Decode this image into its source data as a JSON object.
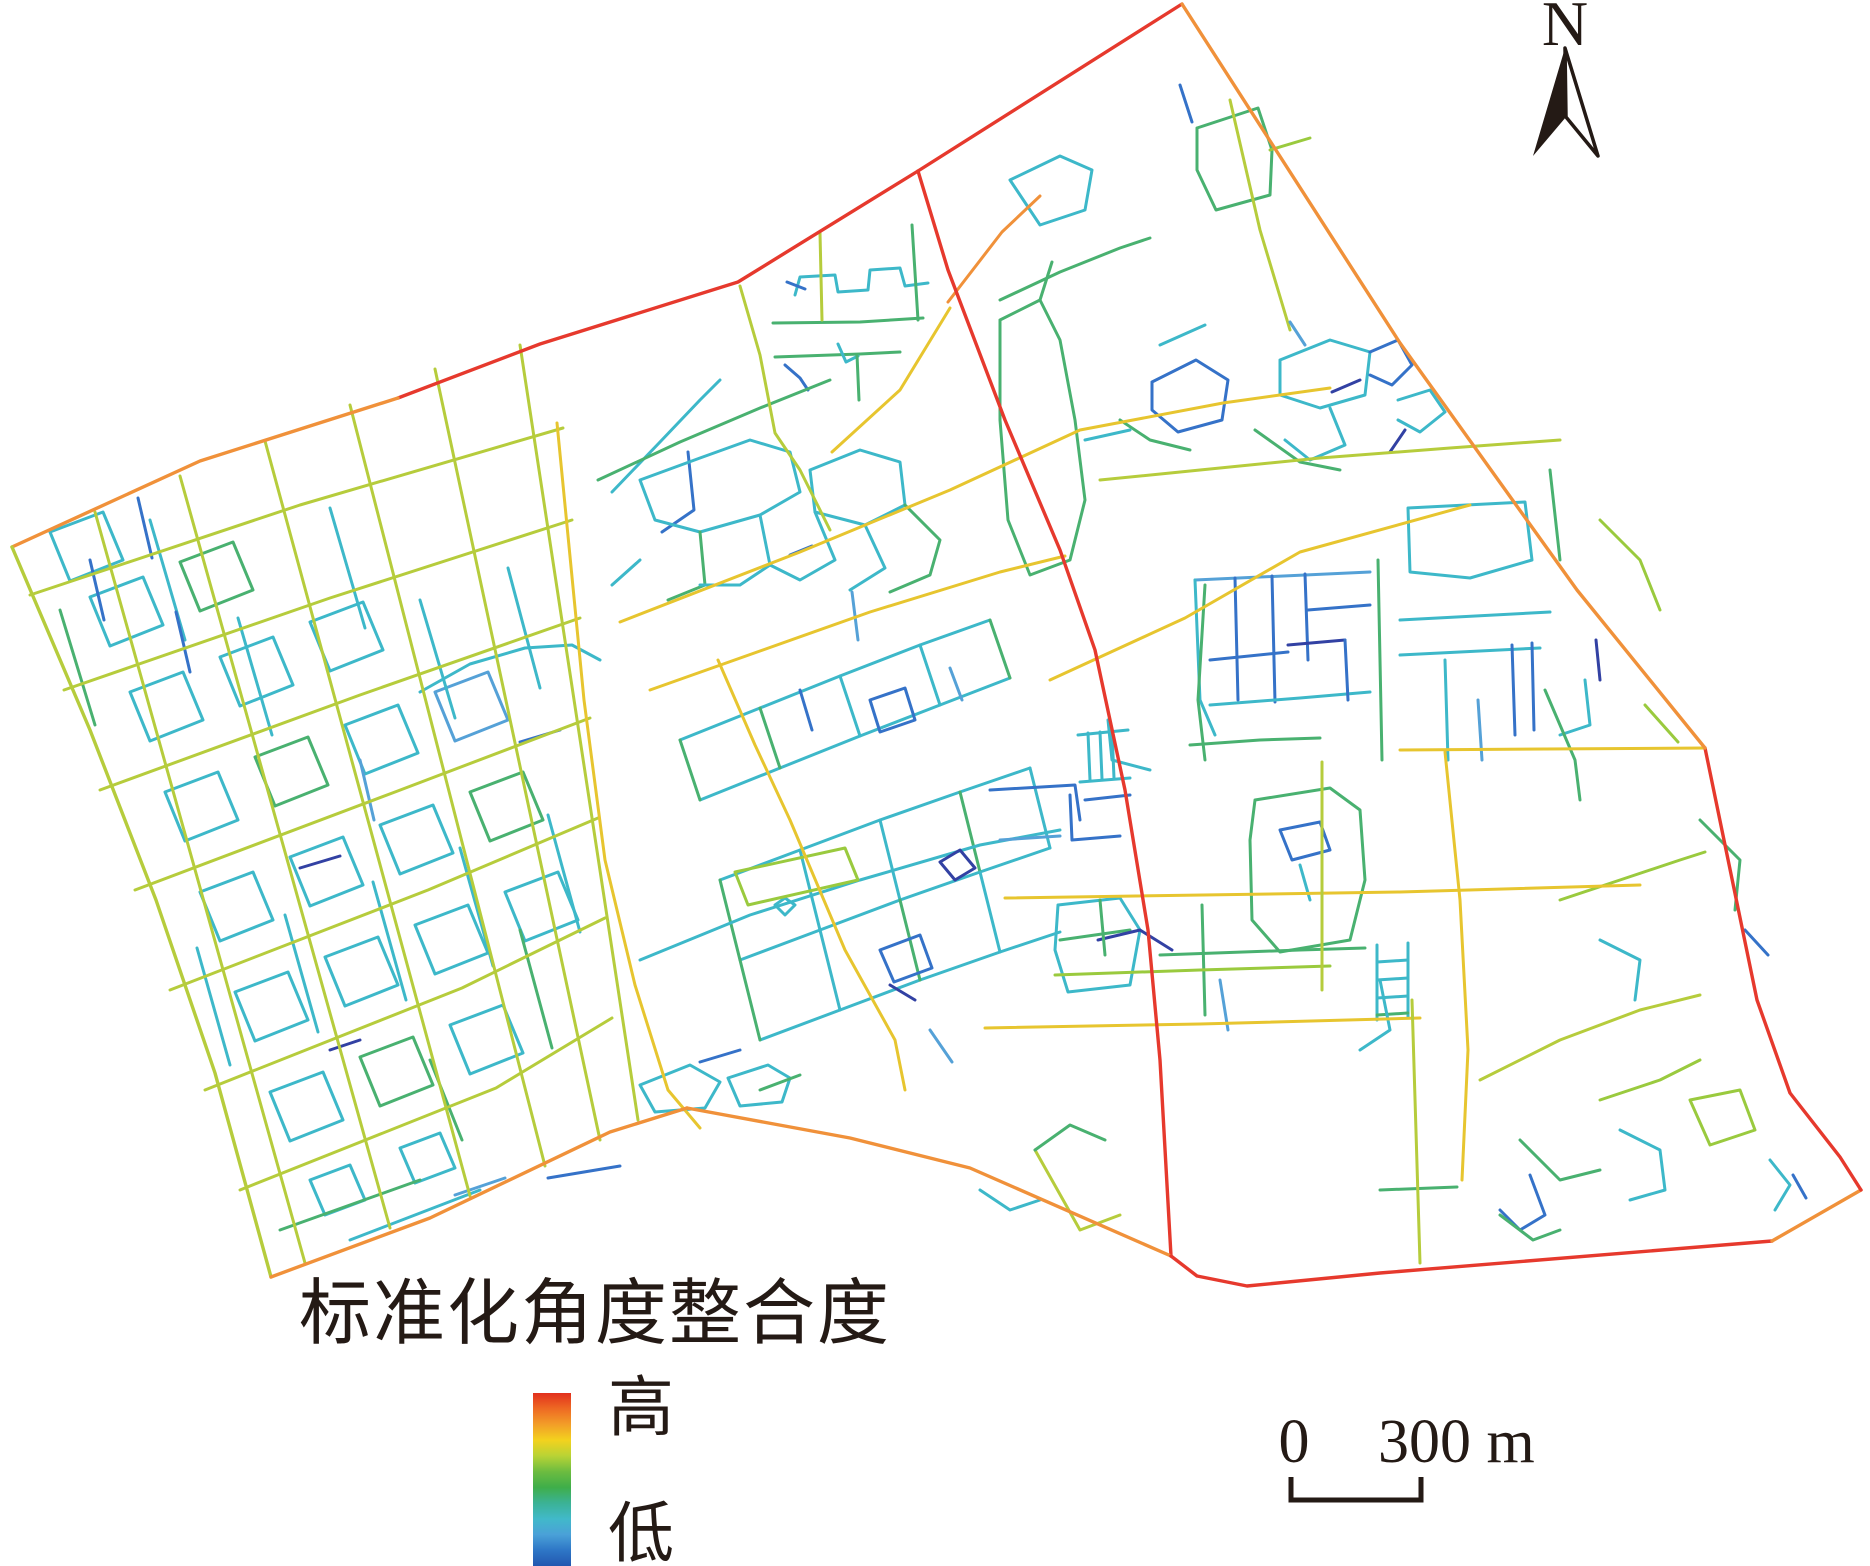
{
  "legend": {
    "title": "标准化角度整合度",
    "high_label": "高",
    "low_label": "低",
    "gradient": [
      "#e2301d",
      "#ee6a23",
      "#f29e28",
      "#f3d21e",
      "#b8d335",
      "#6cbc40",
      "#3fae49",
      "#3bb295",
      "#41b9c9",
      "#4aa1d8",
      "#2e76c6",
      "#2257b0"
    ]
  },
  "north_arrow": {
    "label": "N"
  },
  "scale_bar": {
    "zero_label": "0",
    "distance_label": "300 m"
  },
  "map": {
    "stroke_width": 3,
    "ink": "#241a15",
    "palette": {
      "r": "#e6392d",
      "o": "#f0913a",
      "g": "#e7c52f",
      "y": "#b6cc3c",
      "l": "#9aca3e",
      "e": "#49b170",
      "t": "#3db8c9",
      "lb": "#55a1d7",
      "b": "#3572c8",
      "d": "#3241a3"
    },
    "roads": [
      {
        "c": "t",
        "p": "50,532 103,512 123,560 70,581 50,532"
      },
      {
        "c": "t",
        "p": "90,597 143,577 163,625 110,646 90,597"
      },
      {
        "c": "e",
        "p": "180,562 233,542 253,590 200,611 180,562"
      },
      {
        "c": "t",
        "p": "130,692 183,672 203,720 150,741 130,692"
      },
      {
        "c": "t",
        "p": "220,657 273,637 293,685 240,706 220,657"
      },
      {
        "c": "t",
        "p": "310,622 363,602 383,650 330,671 310,622"
      },
      {
        "c": "t",
        "p": "165,792 218,772 238,820 185,841 165,792"
      },
      {
        "c": "e",
        "p": "255,757 308,737 328,785 275,806 255,757"
      },
      {
        "c": "t",
        "p": "345,725 398,705 418,753 365,774 345,725"
      },
      {
        "c": "lb",
        "p": "435,692 488,672 508,720 455,741 435,692"
      },
      {
        "c": "t",
        "p": "200,892 253,872 273,920 220,941 200,892"
      },
      {
        "c": "t",
        "p": "290,857 343,837 363,885 310,906 290,857"
      },
      {
        "c": "t",
        "p": "380,825 433,805 453,853 400,874 380,825"
      },
      {
        "c": "e",
        "p": "470,792 523,772 543,820 490,841 470,792"
      },
      {
        "c": "t",
        "p": "235,992 288,972 308,1020 255,1041 235,992"
      },
      {
        "c": "t",
        "p": "325,957 378,937 398,985 345,1006 325,957"
      },
      {
        "c": "t",
        "p": "415,925 468,905 488,953 435,974 415,925"
      },
      {
        "c": "t",
        "p": "505,892 558,872 578,920 525,941 505,892"
      },
      {
        "c": "t",
        "p": "270,1092 323,1072 343,1120 290,1141 270,1092"
      },
      {
        "c": "e",
        "p": "360,1057 413,1037 433,1085 380,1106 360,1057"
      },
      {
        "c": "t",
        "p": "450,1025 503,1005 523,1053 470,1074 450,1025"
      },
      {
        "c": "t",
        "p": "310,1180 350,1165 365,1200 325,1215 310,1180"
      },
      {
        "c": "t",
        "p": "400,1148 440,1133 455,1168 415,1183 400,1148"
      },
      {
        "c": "t",
        "p": "150,520 185,640"
      },
      {
        "c": "t",
        "p": "330,508 365,628"
      },
      {
        "c": "t",
        "p": "238,618 272,735"
      },
      {
        "c": "t",
        "p": "420,600 455,718"
      },
      {
        "c": "t",
        "p": "508,568 540,688"
      },
      {
        "c": "t",
        "p": "285,915 318,1032"
      },
      {
        "c": "t",
        "p": "373,882 406,1000"
      },
      {
        "c": "t",
        "p": "197,948 230,1065"
      },
      {
        "c": "t",
        "p": "460,848 493,966"
      },
      {
        "c": "t",
        "p": "548,815 580,932"
      },
      {
        "c": "e",
        "p": "60,610 95,725"
      },
      {
        "c": "e",
        "p": "520,930 552,1048"
      },
      {
        "c": "e",
        "p": "430,1060 462,1140"
      },
      {
        "c": "b",
        "p": "138,498 152,558"
      },
      {
        "c": "b",
        "p": "176,612 190,672"
      },
      {
        "c": "d",
        "p": "300,868 340,856"
      },
      {
        "c": "b",
        "p": "520,742 560,730"
      },
      {
        "c": "b",
        "p": "90,560 104,620"
      },
      {
        "c": "lb",
        "p": "360,760 374,820"
      },
      {
        "c": "e",
        "p": "280,1230 420,1180"
      },
      {
        "c": "t",
        "p": "350,1240 480,1190"
      },
      {
        "c": "d",
        "p": "330,1050 360,1040"
      },
      {
        "c": "b",
        "p": "548,1178 620,1166"
      },
      {
        "c": "lb",
        "p": "455,1195 505,1178"
      },
      {
        "c": "e",
        "p": "773,323 860,322 923,318"
      },
      {
        "c": "e",
        "p": "775,357 860,354 900,352"
      },
      {
        "c": "t",
        "p": "795,295 800,277 835,275 838,292 868,290 870,270 900,268 905,286 928,283"
      },
      {
        "c": "b",
        "p": "787,282 805,289"
      },
      {
        "c": "e",
        "p": "912,225 918,320"
      },
      {
        "c": "t",
        "p": "838,344 846,362 858,356"
      },
      {
        "c": "b",
        "p": "785,365 800,378 808,390"
      },
      {
        "c": "e",
        "p": "857,355 859,400"
      },
      {
        "c": "y",
        "p": "820,233 822,320"
      },
      {
        "c": "t",
        "p": "612,492 660,442 700,400 720,380"
      },
      {
        "c": "e",
        "p": "598,480 680,442 760,408 830,380"
      },
      {
        "c": "b",
        "p": "688,452 694,510 662,532"
      },
      {
        "c": "t",
        "p": "420,692 470,664 525,648 572,645 600,660"
      },
      {
        "c": "t",
        "p": "640,480 700,458 750,440 790,452 800,492 760,515 700,532 655,520 640,480"
      },
      {
        "c": "t",
        "p": "810,470 860,450 900,462 905,505 865,525 815,512 810,470"
      },
      {
        "c": "e",
        "p": "700,532 705,585 668,600"
      },
      {
        "c": "t",
        "p": "760,515 770,565 740,585 700,585"
      },
      {
        "c": "t",
        "p": "815,512 835,560 800,580 770,565"
      },
      {
        "c": "b",
        "p": "790,555 812,546"
      },
      {
        "c": "t",
        "p": "865,525 885,568 850,590"
      },
      {
        "c": "e",
        "p": "905,505 940,540 930,575 890,592"
      },
      {
        "c": "t",
        "p": "640,560 612,585"
      },
      {
        "c": "lb",
        "p": "852,592 858,640"
      },
      {
        "c": "t",
        "p": "680,740 760,708 840,676 920,645 990,620"
      },
      {
        "c": "t",
        "p": "700,800 780,768 860,736 940,705 1010,678"
      },
      {
        "c": "e",
        "p": "680,740 700,800"
      },
      {
        "c": "e",
        "p": "760,708 780,768"
      },
      {
        "c": "t",
        "p": "840,676 860,736"
      },
      {
        "c": "t",
        "p": "920,645 940,705"
      },
      {
        "c": "e",
        "p": "990,620 1010,678"
      },
      {
        "c": "b",
        "p": "870,700 905,688 915,720 880,732 870,700"
      },
      {
        "c": "b",
        "p": "800,690 812,730"
      },
      {
        "c": "lb",
        "p": "950,668 962,700"
      },
      {
        "c": "t",
        "p": "720,880 800,850 880,820 960,792 1030,768"
      },
      {
        "c": "t",
        "p": "740,960 820,930 900,900 980,872 1050,848"
      },
      {
        "c": "e",
        "p": "720,880 740,960"
      },
      {
        "c": "t",
        "p": "800,850 820,930"
      },
      {
        "c": "t",
        "p": "880,820 900,900"
      },
      {
        "c": "e",
        "p": "960,792 980,872"
      },
      {
        "c": "t",
        "p": "1030,768 1050,848"
      },
      {
        "c": "t",
        "p": "760,1040 840,1010 920,980 1000,952 1060,932"
      },
      {
        "c": "e",
        "p": "740,960 760,1040"
      },
      {
        "c": "t",
        "p": "820,930 840,1010"
      },
      {
        "c": "e",
        "p": "900,900 920,980"
      },
      {
        "c": "t",
        "p": "980,872 1000,952"
      },
      {
        "c": "b",
        "p": "880,950 920,935 932,968 894,982 880,950"
      },
      {
        "c": "d",
        "p": "890,985 915,1000"
      },
      {
        "c": "t",
        "p": "640,960 750,915 860,880 980,845 1060,830"
      },
      {
        "c": "t",
        "p": "775,905 785,898 795,905 785,915 775,905"
      },
      {
        "c": "l",
        "p": "735,872 845,848 858,880 748,905 735,872"
      },
      {
        "c": "lb",
        "p": "930,1030 952,1062"
      },
      {
        "c": "t",
        "p": "640,1085 690,1065 720,1082 705,1108 655,1112 640,1085"
      },
      {
        "c": "t",
        "p": "728,1078 768,1065 790,1078 782,1102 740,1106 728,1078"
      },
      {
        "c": "e",
        "p": "760,1090 800,1075"
      },
      {
        "c": "b",
        "p": "700,1062 740,1050"
      },
      {
        "c": "b",
        "p": "990,790 1075,785 1080,820"
      },
      {
        "c": "b",
        "p": "1085,800 1130,795"
      },
      {
        "c": "lb",
        "p": "1000,840 1060,836"
      },
      {
        "c": "d",
        "p": "940,862 960,850 975,868 955,880 940,862"
      },
      {
        "c": "e",
        "p": "1202,905 1205,1015"
      },
      {
        "c": "e",
        "p": "1197,128 1258,108 1272,150 1270,195 1216,210 1197,170 1197,128"
      },
      {
        "c": "l",
        "p": "1270,150 1310,138"
      },
      {
        "c": "e",
        "p": "1000,300 1060,272 1120,248 1150,238"
      },
      {
        "c": "t",
        "p": "1010,180 1060,156 1092,170 1085,210 1040,225 1010,180"
      },
      {
        "c": "b",
        "p": "1180,85 1192,122"
      },
      {
        "c": "y",
        "p": "1230,100 1260,230 1290,330"
      },
      {
        "c": "t",
        "p": "1280,360 1330,340 1370,352 1365,395 1320,408 1280,395 1280,360"
      },
      {
        "c": "t",
        "p": "1330,408 1345,445 1310,460 1285,440"
      },
      {
        "c": "d",
        "p": "1332,392 1360,380"
      },
      {
        "c": "b",
        "p": "1370,352 1398,340 1412,365 1392,385 1370,375"
      },
      {
        "c": "t",
        "p": "1398,400 1430,390 1445,412 1420,432 1398,420"
      },
      {
        "c": "d",
        "p": "1405,430 1390,452"
      },
      {
        "c": "lb",
        "p": "1305,345 1290,322"
      },
      {
        "c": "e",
        "p": "1255,430 1300,462 1340,470"
      },
      {
        "c": "b",
        "p": "1152,382 1196,360 1228,380 1222,420 1178,432 1152,410 1152,382"
      },
      {
        "c": "t",
        "p": "1160,345 1205,325"
      },
      {
        "c": "e",
        "p": "1120,420 1150,440 1190,450"
      },
      {
        "c": "e",
        "p": "1000,320 1040,300 1060,340 1075,420 1085,500 1070,560 1030,575 1008,520 1000,420 1000,320"
      },
      {
        "c": "e",
        "p": "1040,300 1052,262"
      },
      {
        "c": "t",
        "p": "1085,440 1130,430"
      },
      {
        "c": "y",
        "p": "1100,480 1200,470 1320,458 1450,448 1560,440"
      },
      {
        "c": "lb",
        "p": "1195,580 1370,572"
      },
      {
        "c": "b",
        "p": "1235,578 1238,700"
      },
      {
        "c": "b",
        "p": "1272,576 1275,702"
      },
      {
        "c": "b",
        "p": "1305,574 1308,660"
      },
      {
        "c": "d",
        "p": "1288,645 1345,640"
      },
      {
        "c": "b",
        "p": "1210,660 1288,652"
      },
      {
        "c": "b",
        "p": "1308,610 1370,605"
      },
      {
        "c": "t",
        "p": "1195,580 1200,700 1215,735"
      },
      {
        "c": "t",
        "p": "1210,705 1300,698 1370,692"
      },
      {
        "c": "b",
        "p": "1345,640 1348,700"
      },
      {
        "c": "e",
        "p": "1205,585 1198,700 1205,760"
      },
      {
        "c": "e",
        "p": "1378,560 1382,760"
      },
      {
        "c": "t",
        "p": "1408,508 1525,502 1532,560 1470,578 1410,572 1408,508"
      },
      {
        "c": "t",
        "p": "1400,620 1550,612"
      },
      {
        "c": "t",
        "p": "1400,655 1540,648"
      },
      {
        "c": "b",
        "p": "1512,645 1515,735"
      },
      {
        "c": "b",
        "p": "1532,643 1534,730"
      },
      {
        "c": "d",
        "p": "1596,640 1600,680"
      },
      {
        "c": "t",
        "p": "1585,680 1590,725 1560,735"
      },
      {
        "c": "t",
        "p": "1445,660 1448,760"
      },
      {
        "c": "lb",
        "p": "1478,700 1482,760"
      },
      {
        "c": "e",
        "p": "1545,690 1575,760 1580,800"
      },
      {
        "c": "e",
        "p": "1550,470 1560,560"
      },
      {
        "c": "l",
        "p": "1600,520 1640,560 1660,610"
      },
      {
        "c": "t",
        "p": "1078,735 1128,730"
      },
      {
        "c": "t",
        "p": "1080,782 1130,778"
      },
      {
        "c": "t",
        "p": "1088,733 1090,780"
      },
      {
        "c": "t",
        "p": "1100,732 1102,779"
      },
      {
        "c": "t",
        "p": "1112,731 1114,778"
      },
      {
        "c": "b",
        "p": "1070,795 1072,840 1120,836"
      },
      {
        "c": "t",
        "p": "1058,905 1120,898 1140,930 1130,985 1068,992 1055,950 1058,905"
      },
      {
        "c": "e",
        "p": "1060,940 1130,930"
      },
      {
        "c": "d",
        "p": "1098,940 1140,930 1172,950"
      },
      {
        "c": "e",
        "p": "1160,955 1300,950 1365,948"
      },
      {
        "c": "l",
        "p": "1055,975 1200,970 1330,966"
      },
      {
        "c": "t",
        "p": "1377,945 1377,1020"
      },
      {
        "c": "t",
        "p": "1408,943 1408,1018"
      },
      {
        "c": "t",
        "p": "1377,962 1408,960"
      },
      {
        "c": "t",
        "p": "1377,980 1408,978"
      },
      {
        "c": "t",
        "p": "1377,998 1408,996"
      },
      {
        "c": "e",
        "p": "1377,1015 1408,1013"
      },
      {
        "c": "e",
        "p": "1255,800 1330,788 1360,810 1365,880 1350,940 1280,952 1252,920 1250,840 1255,800"
      },
      {
        "c": "b",
        "p": "1280,830 1320,822 1330,850 1292,860 1280,830"
      },
      {
        "c": "t",
        "p": "1300,865 1310,900"
      },
      {
        "c": "t",
        "p": "1380,980 1390,1030 1360,1050"
      },
      {
        "c": "lb",
        "p": "1220,980 1228,1030"
      },
      {
        "c": "e",
        "p": "1100,900 1105,955"
      },
      {
        "c": "y",
        "p": "1035,1150 1080,1230 1120,1215"
      },
      {
        "c": "e",
        "p": "1035,1150 1070,1125 1105,1140"
      },
      {
        "c": "t",
        "p": "980,1190 1010,1210 1040,1200"
      },
      {
        "c": "y",
        "p": "1480,1080 1560,1040 1640,1010 1700,995"
      },
      {
        "c": "l",
        "p": "1600,1100 1660,1080 1700,1060"
      },
      {
        "c": "e",
        "p": "1520,1140 1560,1180 1600,1170"
      },
      {
        "c": "b",
        "p": "1530,1175 1545,1215 1520,1230 1500,1210"
      },
      {
        "c": "t",
        "p": "1620,1130 1660,1150 1665,1190 1630,1200"
      },
      {
        "c": "l",
        "p": "1690,1100 1740,1090 1755,1130 1710,1145 1690,1100"
      },
      {
        "c": "t",
        "p": "1770,1160 1790,1185 1775,1210"
      },
      {
        "c": "b",
        "p": "1793,1175 1806,1198"
      },
      {
        "c": "e",
        "p": "1380,1190 1457,1187"
      },
      {
        "c": "e",
        "p": "1500,1215 1533,1240 1560,1230"
      },
      {
        "c": "l",
        "p": "1560,900 1620,880 1680,860 1705,852"
      },
      {
        "c": "t",
        "p": "1600,940 1640,960 1635,1000"
      },
      {
        "c": "l",
        "p": "1645,705 1678,742"
      },
      {
        "c": "e",
        "p": "1700,820 1740,860 1735,910"
      },
      {
        "c": "b",
        "p": "1745,930 1768,955"
      },
      {
        "c": "t",
        "p": "1108,720 1112,760 1150,770"
      },
      {
        "c": "e",
        "p": "1190,745 1260,740 1320,738"
      },
      {
        "c": "y",
        "p": "30,595 300,505 563,428"
      },
      {
        "c": "y",
        "p": "64,690 330,598 572,520"
      },
      {
        "c": "y",
        "p": "100,790 360,695 580,618"
      },
      {
        "c": "y",
        "p": "135,890 395,792 590,718"
      },
      {
        "c": "y",
        "p": "170,990 428,890 598,818"
      },
      {
        "c": "y",
        "p": "205,1090 462,988 605,918"
      },
      {
        "c": "y",
        "p": "240,1190 496,1088 612,1018"
      },
      {
        "c": "y",
        "p": "95,512 305,1263"
      },
      {
        "c": "y",
        "p": "180,476 390,1228"
      },
      {
        "c": "y",
        "p": "265,441 470,1196"
      },
      {
        "c": "y",
        "p": "350,405 545,1166"
      },
      {
        "c": "y",
        "p": "435,369 600,1140"
      },
      {
        "c": "y",
        "p": "520,345 638,1120"
      },
      {
        "c": "y",
        "p": "740,286 760,355 775,433 800,470 830,530"
      },
      {
        "c": "g",
        "p": "557,423 584,700 605,860 635,985 668,1090 700,1128"
      },
      {
        "c": "g",
        "p": "620,622 800,552 950,490 1080,430 1223,403 1330,388"
      },
      {
        "c": "g",
        "p": "650,690 870,612 1000,572 1065,556"
      },
      {
        "c": "g",
        "p": "1050,680 1185,618 1300,552 1470,505"
      },
      {
        "c": "g",
        "p": "1005,898 1400,892 1640,885"
      },
      {
        "c": "g",
        "p": "1400,750 1705,748"
      },
      {
        "c": "g",
        "p": "718,660 755,745 790,820 845,950 895,1040 905,1090"
      },
      {
        "c": "g",
        "p": "832,452 900,390 950,308"
      },
      {
        "c": "g",
        "p": "985,1028 1200,1024 1420,1018"
      },
      {
        "c": "g",
        "p": "1445,752 1460,900 1468,1050 1462,1180"
      },
      {
        "c": "y",
        "p": "1412,1000 1420,1263"
      },
      {
        "c": "y",
        "p": "1322,762 1322,990"
      },
      {
        "c": "o",
        "p": "948,302 1002,232 1040,196"
      },
      {
        "c": "r",
        "w": 3.4,
        "p": "918,171 948,270 1005,420 1060,550 1095,650 1125,790 1148,930 1160,1060 1171,1256"
      },
      {
        "c": "r",
        "w": 3.4,
        "p": "1182,4 918,171 738,282 540,344 398,398"
      },
      {
        "c": "o",
        "w": 3.4,
        "p": "398,398 200,461 12,547"
      },
      {
        "c": "y",
        "w": 3.4,
        "p": "12,547 90,730 156,900 215,1073 271,1277"
      },
      {
        "c": "o",
        "w": 3.4,
        "p": "271,1277 430,1218 610,1132 687,1108"
      },
      {
        "c": "o",
        "w": 3.4,
        "p": "687,1108 850,1138 970,1168 1171,1256"
      },
      {
        "c": "r",
        "w": 3.4,
        "p": "1171,1256 1197,1276 1247,1286 1380,1273 1772,1241"
      },
      {
        "c": "o",
        "w": 3.4,
        "p": "1772,1241 1861,1190"
      },
      {
        "c": "r",
        "w": 3.4,
        "p": "1861,1190 1840,1157 1790,1093 1757,1000 1705,748"
      },
      {
        "c": "o",
        "w": 3.4,
        "p": "1705,748 1577,590 1400,343 1182,4"
      }
    ]
  }
}
